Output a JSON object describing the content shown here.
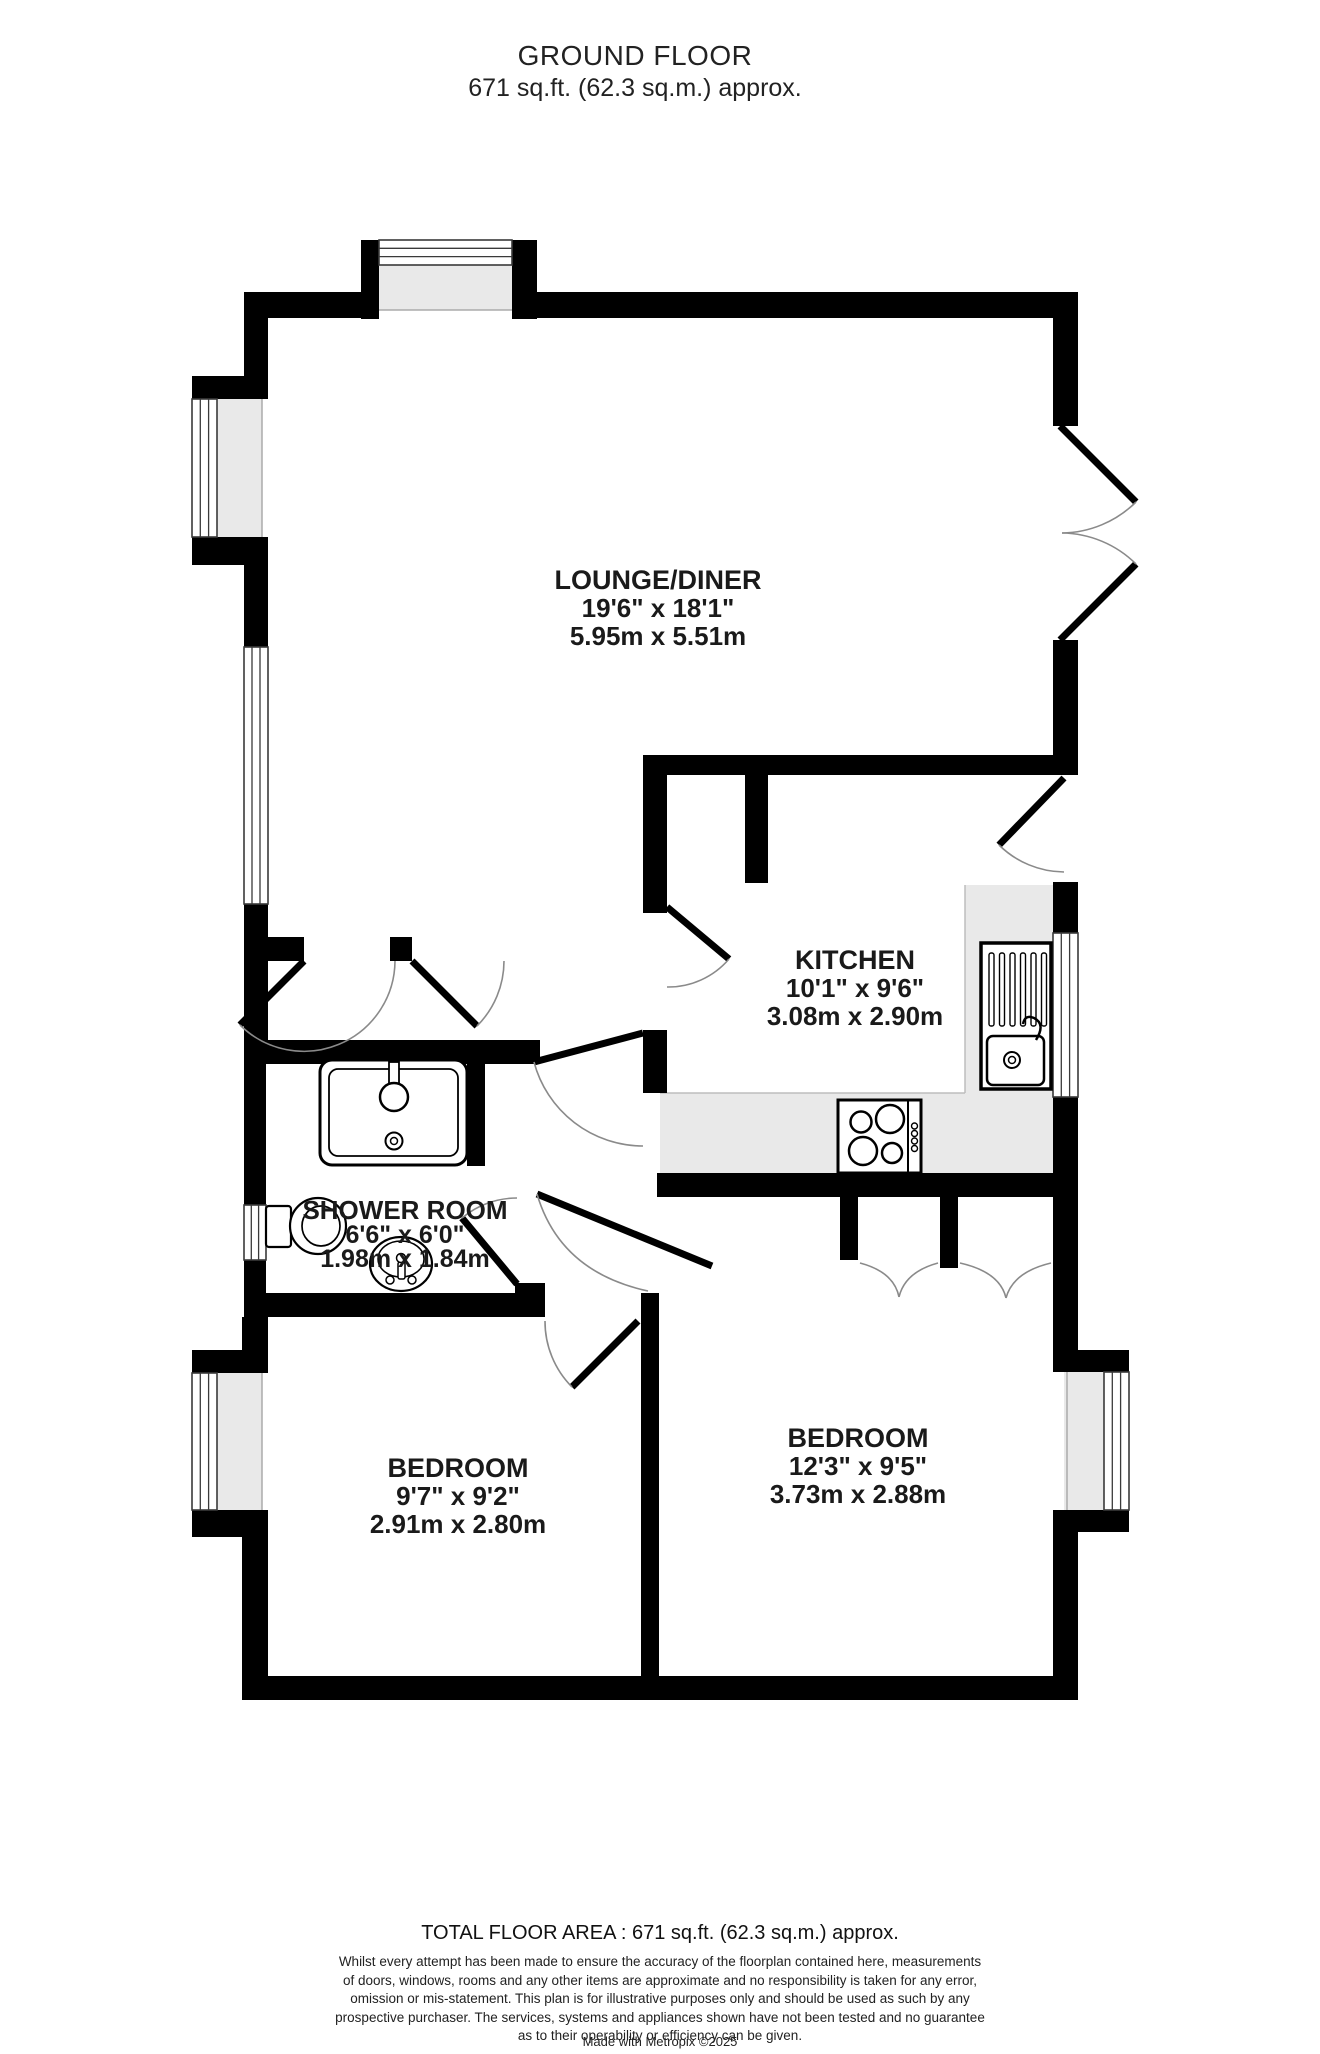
{
  "title": {
    "line1": "GROUND FLOOR",
    "line2": "671 sq.ft. (62.3 sq.m.) approx."
  },
  "rooms": {
    "lounge": {
      "name": "LOUNGE/DINER",
      "imperial": "19'6\" x 18'1\"",
      "metric": "5.95m x 5.51m"
    },
    "kitchen": {
      "name": "KITCHEN",
      "imperial": "10'1\" x 9'6\"",
      "metric": "3.08m x 2.90m"
    },
    "shower": {
      "name": "SHOWER ROOM",
      "imperial": "6'6\" x 6'0\"",
      "metric": "1.98m x 1.84m"
    },
    "bedroom_left": {
      "name": "BEDROOM",
      "imperial": "9'7\" x 9'2\"",
      "metric": "2.91m x 2.80m"
    },
    "bedroom_right": {
      "name": "BEDROOM",
      "imperial": "12'3\" x 9'5\"",
      "metric": "3.73m x 2.88m"
    }
  },
  "footer": {
    "total_area": "TOTAL FLOOR AREA : 671 sq.ft. (62.3 sq.m.) approx.",
    "disclaimer_line1": "Whilst every attempt has been made to ensure the accuracy of the floorplan contained here, measurements",
    "disclaimer_line2": "of doors, windows, rooms and any other items are approximate and no responsibility is taken for any error,",
    "disclaimer_line3": "omission or mis-statement. This plan is for illustrative purposes only and should be used as such by any",
    "disclaimer_line4": "prospective purchaser. The services, systems and appliances shown have not been tested and no guarantee",
    "disclaimer_line5": "as to their operability or efficiency can be given.",
    "credit": "Made with Metropix ©2025"
  },
  "colors": {
    "wall": "#000000",
    "window_fill": "#e9e9e9",
    "background": "#ffffff",
    "text": "#1a1a1a"
  }
}
